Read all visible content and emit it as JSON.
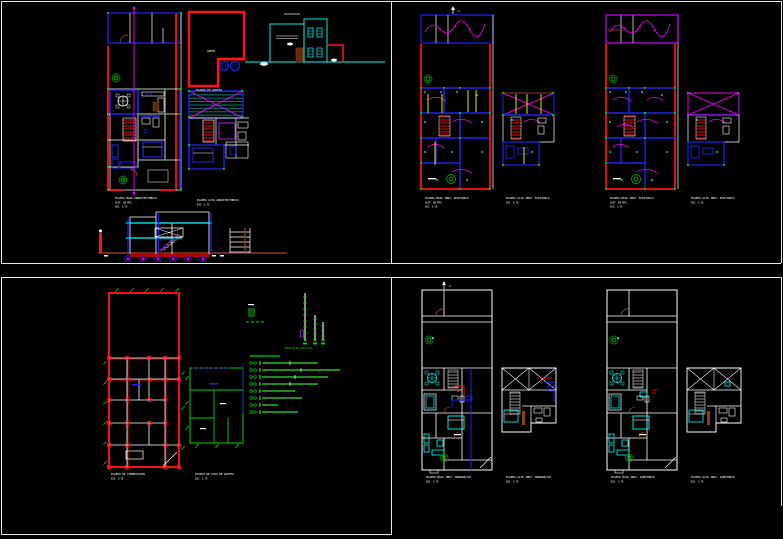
{
  "document": {
    "kind": "CAD sheet set - residential house plans",
    "background": "#000000",
    "viewport_frame_color": "#e9e9e9"
  },
  "palette": {
    "red": "#ff1212",
    "blue": "#2222ee",
    "cyan": "#00ffff",
    "magenta": "#ff00ff",
    "green": "#00d400",
    "dark_green": "#0a7a0a",
    "yellow": "#ffff00",
    "brown": "#8b4513",
    "ground_brown": "#7a3318",
    "purple": "#9a30d0",
    "white": "#ffffff"
  },
  "panels": {
    "arch": {
      "title": "ARQUITECTONICO",
      "captions": {
        "ground": [
          "PLANTA BAJA ARQUITECTONICA",
          "ACOT. EN MTS.",
          "ESC. 1:75"
        ],
        "upper": [
          "PLANTA ALTA ARQUITECTONICA",
          "ESC. 1:75"
        ],
        "roof": [
          "PLANTA DE AZOTEA"
        ],
        "roof_label": "AZOTEA"
      }
    },
    "electrical": {
      "north": "A",
      "captions": {
        "pb1": [
          "PLANTA BAJA INST. ELECTRICA",
          "ACOT. EN MTS.",
          "ESC. 1:75"
        ],
        "pa1": [
          "PLANTA ALTA INST. ELECTRICA",
          "ESC. 1:75"
        ],
        "pb2": [
          "PLANTA BAJA INST. ELECTRICA",
          "ACOT. EN MTS.",
          "ESC. 1:75"
        ],
        "pa2": [
          "PLANTA ALTA INST. ELECTRICA",
          "ESC. 1:75"
        ]
      }
    },
    "structural": {
      "captions": {
        "cimentacion": [
          "PLANTA DE CIMENTACION",
          "ESC. 1:75"
        ],
        "losa": [
          "PLANTA DE LOSA DE AZOTEA",
          "ESC. 1:75"
        ],
        "detalle": "DETALLE DE CASTILLOS"
      }
    },
    "hydraulic": {
      "north": "A",
      "captions": {
        "pb1": [
          "PLANTA BAJA INST. HIDRAULICA",
          "ESC. 1:75"
        ],
        "pa1": [
          "PLANTA ALTA INST. HIDRAULICA",
          "ESC. 1:75"
        ],
        "pb2": [
          "PLANTA BAJA INST. SANITARIA",
          "ESC. 1:75"
        ],
        "pa2": [
          "PLANTA ALTA INST. SANITARIA",
          "ESC. 1:75"
        ]
      }
    }
  }
}
